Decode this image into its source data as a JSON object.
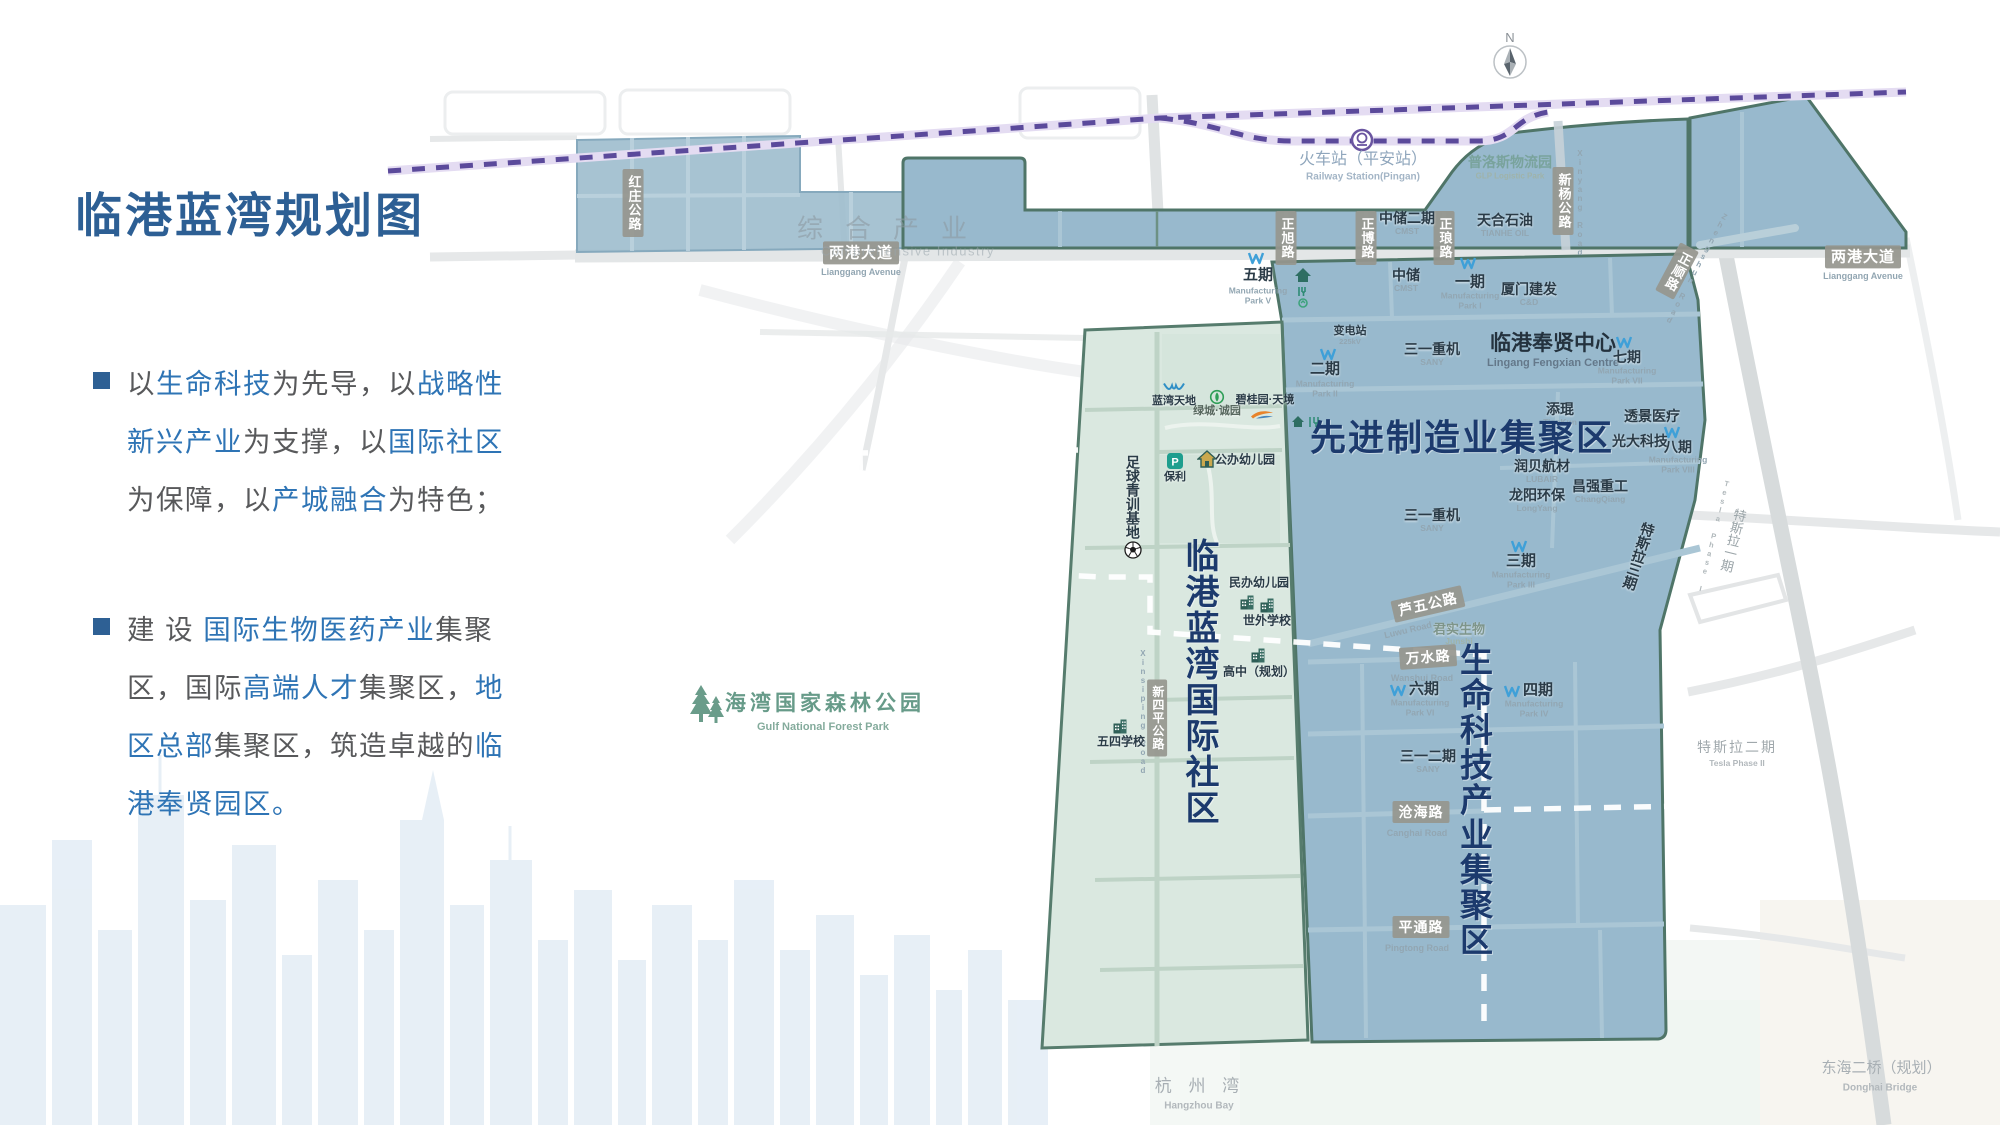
{
  "slide": {
    "title": "临港蓝湾规划图",
    "bullets": [
      {
        "lines": [
          [
            {
              "t": "以",
              "c": "g"
            },
            {
              "t": "生命科技",
              "c": "b"
            },
            {
              "t": "为先导，以",
              "c": "g"
            },
            {
              "t": "战略性",
              "c": "b"
            }
          ],
          [
            {
              "t": "新兴产业",
              "c": "b"
            },
            {
              "t": "为支撑，以",
              "c": "g"
            },
            {
              "t": "国际社区",
              "c": "b"
            }
          ],
          [
            {
              "t": "为保障，以",
              "c": "g"
            },
            {
              "t": "产城融合",
              "c": "b"
            },
            {
              "t": "为特色；",
              "c": "g"
            }
          ]
        ]
      },
      {
        "lines": [
          [
            {
              "t": "建 设 ",
              "c": "g"
            },
            {
              "t": "国际生物医药产业",
              "c": "b"
            },
            {
              "t": "集聚",
              "c": "g"
            }
          ],
          [
            {
              "t": "区，国际",
              "c": "g"
            },
            {
              "t": "高端人才",
              "c": "b"
            },
            {
              "t": "集聚区，",
              "c": "g"
            },
            {
              "t": "地",
              "c": "b"
            }
          ],
          [
            {
              "t": "区总部",
              "c": "b"
            },
            {
              "t": "集聚区，筑造卓越的",
              "c": "g"
            },
            {
              "t": "临",
              "c": "b"
            }
          ],
          [
            {
              "t": "港奉贤园区。",
              "c": "b"
            }
          ]
        ]
      }
    ]
  },
  "compass": {
    "n": "N"
  },
  "colors": {
    "title_blue": "#2d5f94",
    "body_blue": "#2e74b5",
    "body_gray": "#58595b",
    "region_blue": "#92b5ca",
    "region_green": "#d9e7df",
    "outline_teal": "#4f7568",
    "rail_purple": "#5b4a9b",
    "badge_gray": "#96968e",
    "navy_label": "#1c3a6d"
  },
  "map": {
    "labels": [
      {
        "type": "badge",
        "v": 1,
        "t": "红庄公路",
        "x": 633,
        "y": 203,
        "fs": 13,
        "name": "road-badge-hongzhuang"
      },
      {
        "type": "badge",
        "t": "两港大道",
        "x": 861,
        "y": 253,
        "fs": 15,
        "name": "road-badge-lianggang-west"
      },
      {
        "type": "sub",
        "t": "Lianggang Avenue",
        "x": 861,
        "y": 272,
        "fs": 9
      },
      {
        "type": "badge",
        "t": "两港大道",
        "x": 1863,
        "y": 257,
        "fs": 15,
        "name": "road-badge-lianggang-east"
      },
      {
        "type": "sub",
        "t": "Lianggang Avenue",
        "x": 1863,
        "y": 276,
        "fs": 9
      },
      {
        "type": "badge",
        "v": 1,
        "t": "正旭路",
        "x": 1286,
        "y": 238,
        "fs": 13,
        "name": "road-badge-zhengxu"
      },
      {
        "type": "badge",
        "v": 1,
        "t": "正博路",
        "x": 1366,
        "y": 238,
        "fs": 13,
        "name": "road-badge-zhengbo"
      },
      {
        "type": "badge",
        "v": 1,
        "t": "正琅路",
        "x": 1444,
        "y": 238,
        "fs": 13,
        "name": "road-badge-zhenglang"
      },
      {
        "type": "badge",
        "v": 1,
        "t": "新杨公路",
        "x": 1563,
        "y": 201,
        "fs": 13,
        "name": "road-badge-xinyang"
      },
      {
        "type": "sub",
        "v": 1,
        "t": "Xinyang Road",
        "x": 1579,
        "y": 203,
        "fs": 8
      },
      {
        "type": "badge",
        "v": 1,
        "t": "正顺路",
        "x": 1677,
        "y": 271,
        "fs": 13,
        "rot": 28,
        "name": "road-badge-zhengshun"
      },
      {
        "type": "sub",
        "v": 1,
        "t": "Zhengshun Road",
        "x": 1696,
        "y": 268,
        "fs": 8,
        "rot": 28
      },
      {
        "type": "badge",
        "t": "芦五公路",
        "x": 1428,
        "y": 604,
        "fs": 14,
        "rot": -13,
        "name": "road-badge-luwu"
      },
      {
        "type": "sub",
        "t": "Luwu Road",
        "x": 1408,
        "y": 630,
        "fs": 9,
        "rot": -13
      },
      {
        "type": "badge",
        "t": "万水路",
        "x": 1428,
        "y": 657,
        "fs": 14,
        "rot": -4,
        "name": "road-badge-wanshui"
      },
      {
        "type": "sub",
        "t": "Wanshui Road",
        "x": 1422,
        "y": 678,
        "fs": 9
      },
      {
        "type": "badge",
        "t": "沧海路",
        "x": 1421,
        "y": 812,
        "fs": 14,
        "name": "road-badge-canghai"
      },
      {
        "type": "sub",
        "t": "Canghai Road",
        "x": 1417,
        "y": 833,
        "fs": 9
      },
      {
        "type": "badge",
        "t": "平通路",
        "x": 1421,
        "y": 927,
        "fs": 14,
        "name": "road-badge-pingtong"
      },
      {
        "type": "sub",
        "t": "Pingtong Road",
        "x": 1417,
        "y": 948,
        "fs": 9
      },
      {
        "type": "badge",
        "v": 1,
        "t": "新四平公路",
        "x": 1157,
        "y": 718,
        "fs": 12,
        "name": "road-badge-xinsiping"
      },
      {
        "type": "sub",
        "v": 1,
        "t": "Xinsiping Road",
        "x": 1142,
        "y": 712,
        "fs": 8
      },
      {
        "type": "icon",
        "icon": "w",
        "x": 1256,
        "y": 258
      },
      {
        "type": "fac",
        "t": "五期",
        "x": 1258,
        "y": 276,
        "fs": 15
      },
      {
        "type": "sub",
        "t": "Manufacturing\nPark V",
        "x": 1258,
        "y": 296
      },
      {
        "type": "fac",
        "t": "中储二期",
        "x": 1407,
        "y": 219,
        "fs": 14
      },
      {
        "type": "sub",
        "t": "CMST",
        "x": 1407,
        "y": 232
      },
      {
        "type": "fac",
        "t": "天合石油",
        "x": 1505,
        "y": 221,
        "fs": 14
      },
      {
        "type": "sub",
        "t": "TIANHE OIL",
        "x": 1505,
        "y": 234
      },
      {
        "type": "fac",
        "t": "中储",
        "x": 1406,
        "y": 276,
        "fs": 14
      },
      {
        "type": "sub",
        "t": "CMST",
        "x": 1406,
        "y": 289
      },
      {
        "type": "icon",
        "icon": "w",
        "x": 1468,
        "y": 263
      },
      {
        "type": "fac",
        "t": "一期",
        "x": 1470,
        "y": 283,
        "fs": 15
      },
      {
        "type": "sub",
        "t": "Manufacturing\nPark I",
        "x": 1470,
        "y": 301
      },
      {
        "type": "fac",
        "t": "厦门建发",
        "x": 1529,
        "y": 290,
        "fs": 14
      },
      {
        "type": "sub",
        "t": "C&D",
        "x": 1529,
        "y": 303
      },
      {
        "type": "icon",
        "icon": "homefork",
        "x": 1303,
        "y": 288
      },
      {
        "type": "icon",
        "icon": "homefork2",
        "x": 1306,
        "y": 422
      },
      {
        "type": "fac",
        "t": "三一重机",
        "x": 1432,
        "y": 350,
        "fs": 14
      },
      {
        "type": "sub",
        "t": "SANY",
        "x": 1432,
        "y": 363
      },
      {
        "type": "fac-lg",
        "t": "临港奉贤中心",
        "x": 1553,
        "y": 344,
        "fs": 21,
        "name": "lingang-fengxian-centre-label"
      },
      {
        "type": "sub",
        "t": "Lingang Fengxian Centre",
        "x": 1553,
        "y": 363,
        "fs": 11,
        "c": "#64788a"
      },
      {
        "type": "icon",
        "icon": "w",
        "x": 1624,
        "y": 342
      },
      {
        "type": "fac",
        "t": "七期",
        "x": 1627,
        "y": 358,
        "fs": 14
      },
      {
        "type": "sub",
        "t": "Manufacturing\nPark VII",
        "x": 1627,
        "y": 376
      },
      {
        "type": "fac",
        "t": "变电站",
        "x": 1350,
        "y": 331,
        "fs": 11
      },
      {
        "type": "sub",
        "t": "225kV",
        "x": 1350,
        "y": 342,
        "fs": 7.5
      },
      {
        "type": "icon",
        "icon": "w",
        "x": 1328,
        "y": 354
      },
      {
        "type": "fac",
        "t": "二期",
        "x": 1325,
        "y": 370,
        "fs": 15
      },
      {
        "type": "sub",
        "t": "Manufacturing\nPark II",
        "x": 1325,
        "y": 389
      },
      {
        "type": "fac",
        "t": "添琨",
        "x": 1560,
        "y": 410,
        "fs": 14
      },
      {
        "type": "sub",
        "t": "TianKun",
        "x": 1560,
        "y": 423
      },
      {
        "type": "fac",
        "t": "透景医疗",
        "x": 1652,
        "y": 417,
        "fs": 14
      },
      {
        "type": "fac",
        "t": "光大科技",
        "x": 1640,
        "y": 442,
        "fs": 14
      },
      {
        "type": "icon",
        "icon": "w",
        "x": 1672,
        "y": 432
      },
      {
        "type": "fac",
        "t": "八期",
        "x": 1678,
        "y": 448,
        "fs": 14
      },
      {
        "type": "sub",
        "t": "Manufacturing\nPark VIII",
        "x": 1678,
        "y": 465
      },
      {
        "type": "fac",
        "t": "润贝航材",
        "x": 1542,
        "y": 467,
        "fs": 14
      },
      {
        "type": "sub",
        "t": "LUBAIR",
        "x": 1542,
        "y": 480
      },
      {
        "type": "fac",
        "t": "龙阳环保",
        "x": 1537,
        "y": 496,
        "fs": 14
      },
      {
        "type": "sub",
        "t": "LongYang",
        "x": 1537,
        "y": 509
      },
      {
        "type": "fac",
        "t": "昌强重工",
        "x": 1600,
        "y": 487,
        "fs": 14
      },
      {
        "type": "sub",
        "t": "ChangQiang",
        "x": 1600,
        "y": 500
      },
      {
        "type": "fac",
        "t": "三一重机",
        "x": 1432,
        "y": 516,
        "fs": 14
      },
      {
        "type": "sub",
        "t": "SANY",
        "x": 1432,
        "y": 529
      },
      {
        "type": "icon",
        "icon": "w",
        "x": 1519,
        "y": 546
      },
      {
        "type": "fac",
        "t": "三期",
        "x": 1521,
        "y": 562,
        "fs": 15
      },
      {
        "type": "sub",
        "t": "Manufacturing\nPark III",
        "x": 1521,
        "y": 580
      },
      {
        "type": "fac",
        "t": "特斯拉三期",
        "x": 1638,
        "y": 556,
        "fs": 14,
        "v": 1,
        "rot": 18,
        "name": "tesla-phase3-label"
      },
      {
        "type": "fac",
        "t": "君实生物",
        "x": 1459,
        "y": 630,
        "fs": 13,
        "c": "#7e958a"
      },
      {
        "type": "sub",
        "t": "Junshi",
        "x": 1459,
        "y": 642,
        "c": "#9fb3a9"
      },
      {
        "type": "icon",
        "icon": "w",
        "x": 1398,
        "y": 690
      },
      {
        "type": "fac",
        "t": "六期",
        "x": 1424,
        "y": 690,
        "fs": 15
      },
      {
        "type": "sub",
        "t": "Manufacturing\nPark VI",
        "x": 1420,
        "y": 708
      },
      {
        "type": "icon",
        "icon": "w",
        "x": 1512,
        "y": 691
      },
      {
        "type": "fac",
        "t": "四期",
        "x": 1538,
        "y": 691,
        "fs": 15
      },
      {
        "type": "sub",
        "t": "Manufacturing\nPark IV",
        "x": 1534,
        "y": 709
      },
      {
        "type": "fac",
        "t": "三一二期",
        "x": 1428,
        "y": 757,
        "fs": 14
      },
      {
        "type": "sub",
        "t": "SANY",
        "x": 1428,
        "y": 770
      },
      {
        "type": "icon",
        "icon": "bird",
        "x": 1174,
        "y": 388
      },
      {
        "type": "fac",
        "t": "蓝湾天地",
        "x": 1174,
        "y": 401,
        "fs": 11
      },
      {
        "type": "icon",
        "icon": "green",
        "x": 1217,
        "y": 397
      },
      {
        "type": "fac",
        "t": "绿城·诚园",
        "x": 1217,
        "y": 411,
        "fs": 11,
        "c": "#57675e"
      },
      {
        "type": "fac",
        "t": "碧桂园·天境",
        "x": 1265,
        "y": 400,
        "fs": 11
      },
      {
        "type": "icon",
        "icon": "phoenix",
        "x": 1262,
        "y": 414
      },
      {
        "type": "icon",
        "icon": "poly",
        "x": 1175,
        "y": 461
      },
      {
        "type": "fac",
        "t": "保利",
        "x": 1175,
        "y": 477,
        "fs": 11
      },
      {
        "type": "icon",
        "icon": "house2",
        "x": 1207,
        "y": 459
      },
      {
        "type": "fac",
        "t": "公办幼儿园",
        "x": 1245,
        "y": 460,
        "fs": 12
      },
      {
        "type": "fac",
        "t": "足球青训基地",
        "x": 1132,
        "y": 497,
        "fs": 14,
        "v": 1,
        "name": "football-training-base-label"
      },
      {
        "type": "icon",
        "icon": "ball",
        "x": 1133,
        "y": 550
      },
      {
        "type": "fac",
        "t": "民办幼儿园",
        "x": 1259,
        "y": 583,
        "fs": 12
      },
      {
        "type": "icon",
        "icon": "school",
        "x": 1247,
        "y": 602
      },
      {
        "type": "icon",
        "icon": "school",
        "x": 1267,
        "y": 605
      },
      {
        "type": "fac",
        "t": "世外学校",
        "x": 1267,
        "y": 621,
        "fs": 12
      },
      {
        "type": "icon",
        "icon": "school",
        "x": 1258,
        "y": 655
      },
      {
        "type": "fac",
        "t": "高中（规划）",
        "x": 1259,
        "y": 672,
        "fs": 12
      },
      {
        "type": "icon",
        "icon": "school",
        "x": 1120,
        "y": 726
      },
      {
        "type": "fac",
        "t": "五四学校",
        "x": 1121,
        "y": 742,
        "fs": 12
      },
      {
        "type": "teal",
        "t": "普洛斯物流园",
        "x": 1510,
        "y": 163,
        "fs": 14,
        "op": 0.75,
        "name": "glp-park-label"
      },
      {
        "type": "sub",
        "t": "GLP Logistic Park",
        "x": 1510,
        "y": 177,
        "fs": 8,
        "c": "#9fb3a9"
      },
      {
        "type": "rail",
        "t": "火车站（平安站）",
        "x": 1363,
        "y": 160,
        "fs": 16,
        "name": "railway-station-label"
      },
      {
        "type": "sub",
        "t": "Railway Station(Pingan)",
        "x": 1363,
        "y": 177,
        "fs": 10,
        "c": "#a3b5c6"
      },
      {
        "type": "muted",
        "t": "综合产业",
        "x": 893,
        "y": 229,
        "fs": 26,
        "ls": 22,
        "op": 0.6,
        "c": "#8e9ba3",
        "name": "comprehensive-industry-label"
      },
      {
        "type": "muted",
        "t": "Comprehensive Industry",
        "x": 908,
        "y": 252,
        "fs": 13,
        "ls": 1.5,
        "op": 0.55,
        "c": "#99a5ac"
      },
      {
        "type": "teal",
        "t": "海湾国家森林公园",
        "x": 825,
        "y": 704,
        "fs": 21,
        "ls": 4,
        "c": "#679b89",
        "name": "gulf-forest-park-label"
      },
      {
        "type": "sub",
        "t": "Gulf National Forest Park",
        "x": 823,
        "y": 727,
        "fs": 11,
        "c": "#84ab9c"
      },
      {
        "type": "icon",
        "icon": "trees",
        "x": 707,
        "y": 705
      },
      {
        "type": "muted",
        "t": "杭 州 湾",
        "x": 1200,
        "y": 1086,
        "fs": 17,
        "ls": 6,
        "c": "#a8afb4",
        "name": "hangzhou-bay-label"
      },
      {
        "type": "sub",
        "t": "Hangzhou Bay",
        "x": 1199,
        "y": 1106,
        "fs": 10,
        "c": "#b2b8bc"
      },
      {
        "type": "muted",
        "t": "东海二桥（规划）",
        "x": 1881,
        "y": 1069,
        "fs": 15,
        "c": "#a8afb4",
        "name": "donghai-bridge-label"
      },
      {
        "type": "sub",
        "t": "Donghai Bridge",
        "x": 1880,
        "y": 1088,
        "fs": 10,
        "c": "#b2b8bc"
      },
      {
        "type": "muted",
        "t": "特斯拉一期",
        "x": 1732,
        "y": 540,
        "fs": 13,
        "v": 1,
        "rot": 14,
        "c": "#9aa4a8",
        "name": "tesla-phase1-label"
      },
      {
        "type": "sub",
        "v": 1,
        "t": "Tesla Phase I",
        "x": 1713,
        "y": 536,
        "fs": 7.5,
        "rot": 14,
        "c": "#b0b8bb"
      },
      {
        "type": "muted",
        "t": "特斯拉二期",
        "x": 1737,
        "y": 748,
        "fs": 14,
        "ls": 2,
        "c": "#a0a8ac",
        "name": "tesla-phase2-label"
      },
      {
        "type": "sub",
        "t": "Tesla Phase II",
        "x": 1737,
        "y": 764,
        "fs": 8.5,
        "c": "#b2b8bc"
      },
      {
        "type": "big",
        "t": "先进制造业集聚区",
        "x": 1462,
        "y": 438,
        "fs": 36,
        "name": "advanced-manufacturing-zone-label"
      },
      {
        "type": "big",
        "t": "临港蓝湾国际社区",
        "x": 1199,
        "y": 682,
        "fs": 34,
        "v": 1,
        "name": "international-community-zone-label"
      },
      {
        "type": "big",
        "t": "生命科技产业集聚区",
        "x": 1473,
        "y": 800,
        "fs": 33,
        "v": 1,
        "name": "life-science-zone-label"
      }
    ]
  }
}
